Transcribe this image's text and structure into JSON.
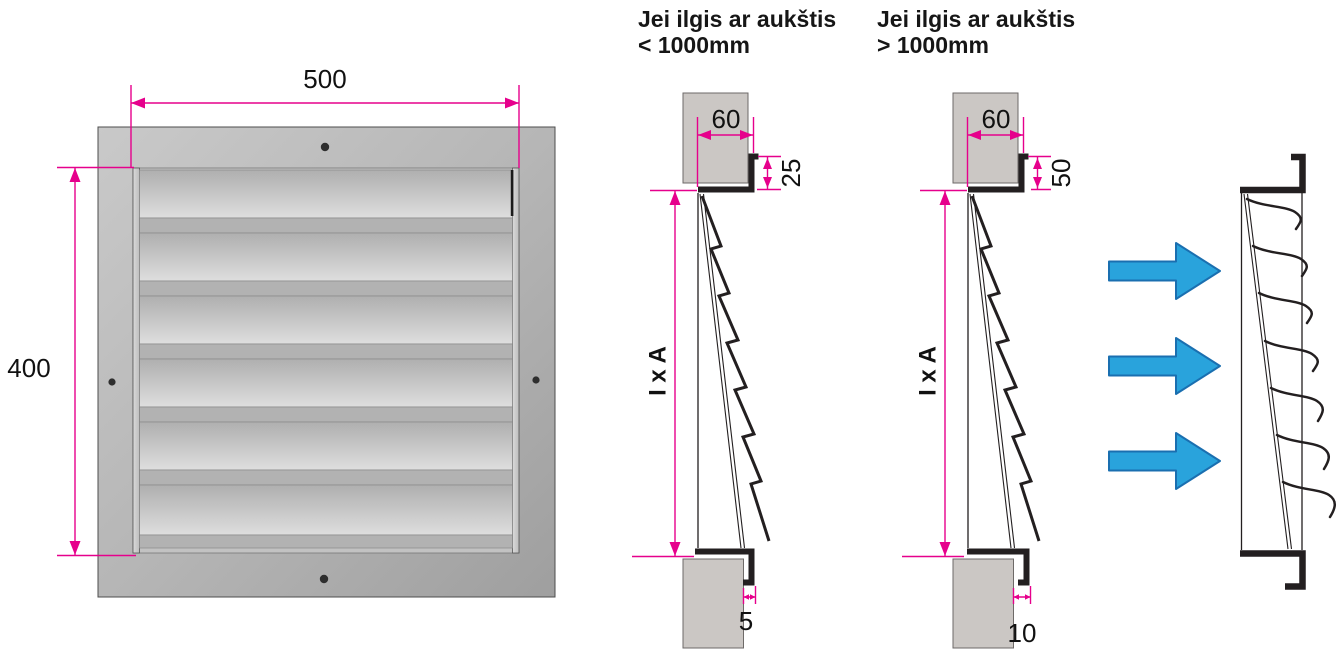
{
  "front_view": {
    "width_dim": "500",
    "height_dim": "400"
  },
  "section_small": {
    "title_line1": "Jei ilgis ar aukštis",
    "title_line2": "< 1000mm",
    "wall_depth_dim": "60",
    "flange_dim": "25",
    "gap_dim": "5",
    "opening_dim": "I x A"
  },
  "section_large": {
    "title_line1": "Jei ilgis ar aukštis",
    "title_line2": "> 1000mm",
    "wall_depth_dim": "60",
    "flange_dim": "50",
    "gap_dim": "10",
    "opening_dim": "I x A"
  },
  "icons": {
    "airflow_arrow": "right-arrow"
  },
  "colors": {
    "dimension_magenta": "#E6008C",
    "airflow_arrow_fill": "#29A3DC",
    "airflow_arrow_stroke": "#1A6FB0",
    "linework_black": "#231F20",
    "wall_fill": "#CBC7C4",
    "frame_gray": "#B5B5B5",
    "slat_light": "#DEDEDE",
    "background": "#FFFFFF"
  }
}
